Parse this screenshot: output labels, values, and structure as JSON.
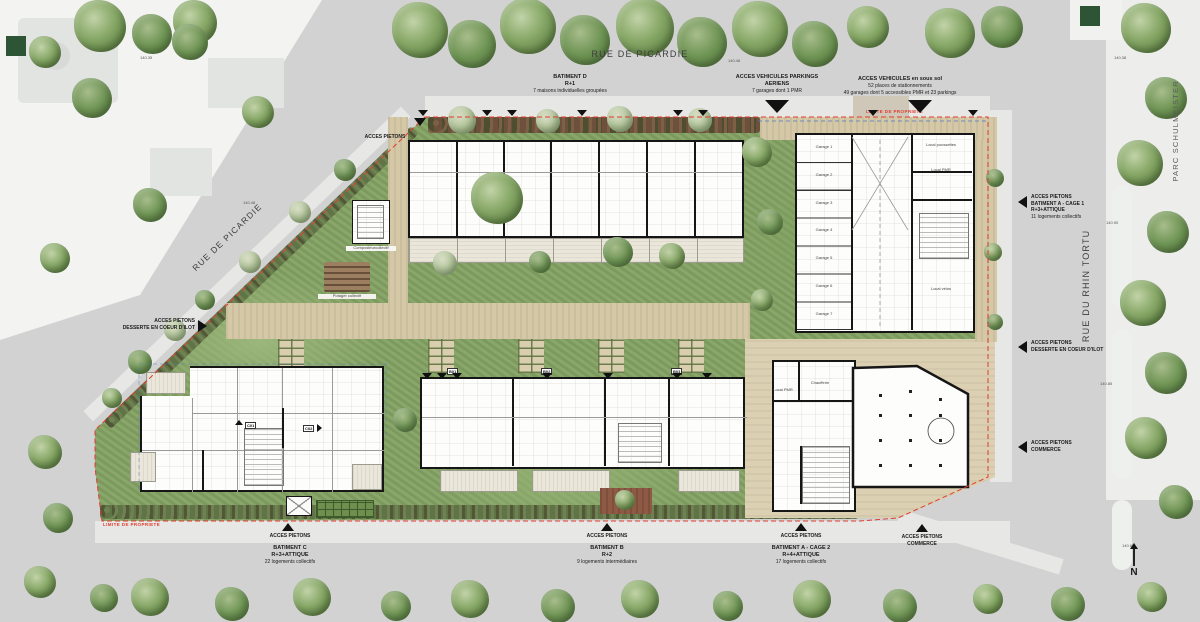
{
  "streets": {
    "rue_picardie_top": "RUE DE PICARDIE",
    "rue_picardie_diag": "RUE DE PICARDIE",
    "rue_rhin_tortu": "RUE DU RHIN TORTU",
    "parc": "PARC SCHULMEISTER"
  },
  "compass_n": "N",
  "limite_propriete": "LIMITE DE PROPRIETE",
  "elevations": [
    "140.35",
    "140.46",
    "140.38",
    "140.48",
    "140.90",
    "140.85",
    "140.65"
  ],
  "annotations": {
    "batiment_d": {
      "l1": "BATIMENT D",
      "l2": "R+1",
      "l3": "7 maisons individuelles groupées"
    },
    "acces_pietons_top": "ACCES PIETONS",
    "vehicules_aeriens": {
      "l1": "ACCES VEHICULES PARKINGS",
      "l2": "AERIENS",
      "l3": "7 garages dont 1 PMR"
    },
    "vehicules_sous_sol": {
      "l1": "ACCES VEHICULES en sous sol",
      "l2": "52 places de stationnements",
      "l3": "49 garages dont 5 accessibles PMR et 23 parkings"
    },
    "left_desserte": {
      "l1": "ACCES PIETONS",
      "l2": "DESSERTE EN COEUR D'ILOT"
    },
    "cage1": {
      "l1": "ACCES PIETONS",
      "l2": "BATIMENT A - CAGE 1",
      "l3": "R+3+ATTIQUE",
      "l4": "11 logements collectifs"
    },
    "right_desserte": {
      "l1": "ACCES PIETONS",
      "l2": "DESSERTE EN COEUR D'ILOT"
    },
    "right_commerce": {
      "l1": "ACCES PIETONS",
      "l2": "COMMERCE"
    },
    "batiment_c": {
      "acces": "ACCES PIETONS",
      "l1": "BATIMENT C",
      "l2": "R+3+ATTIQUE",
      "l3": "22 logements collectifs"
    },
    "batiment_b": {
      "acces": "ACCES PIETONS",
      "l1": "BATIMENT B",
      "l2": "R+2",
      "l3": "9 logements intermédiaires"
    },
    "batiment_a2": {
      "acces": "ACCES PIETONS",
      "l1": "BATIMENT A - CAGE 2",
      "l2": "R+4+ATTIQUE",
      "l3": "17 logements collectifs"
    },
    "bottom_commerce": {
      "l1": "ACCES PIETONS",
      "l2": "COMMERCE"
    }
  },
  "site_labels": {
    "composteur_l1": "Composteur",
    "composteur_l2": "collectif",
    "potager": "Potager collectif",
    "garages": [
      "Garage 1",
      "Garage 2",
      "Garage 3",
      "Garage 4",
      "Garage 5",
      "Garage 6",
      "Garage 7"
    ],
    "local_velos": "Local vélos",
    "local_poussettes": "Local poussettes",
    "local_pmr": "Local PMR",
    "chaufferie": "Chaufferie",
    "commerce": "Commerce",
    "entries": {
      "b01": "B01",
      "b02": "B02",
      "b03": "B03",
      "c01": "C01",
      "c02": "C02"
    }
  },
  "colors": {
    "property_line": "#e03c30",
    "attique_line": "#4f7fc4",
    "arrow": "#111111"
  }
}
